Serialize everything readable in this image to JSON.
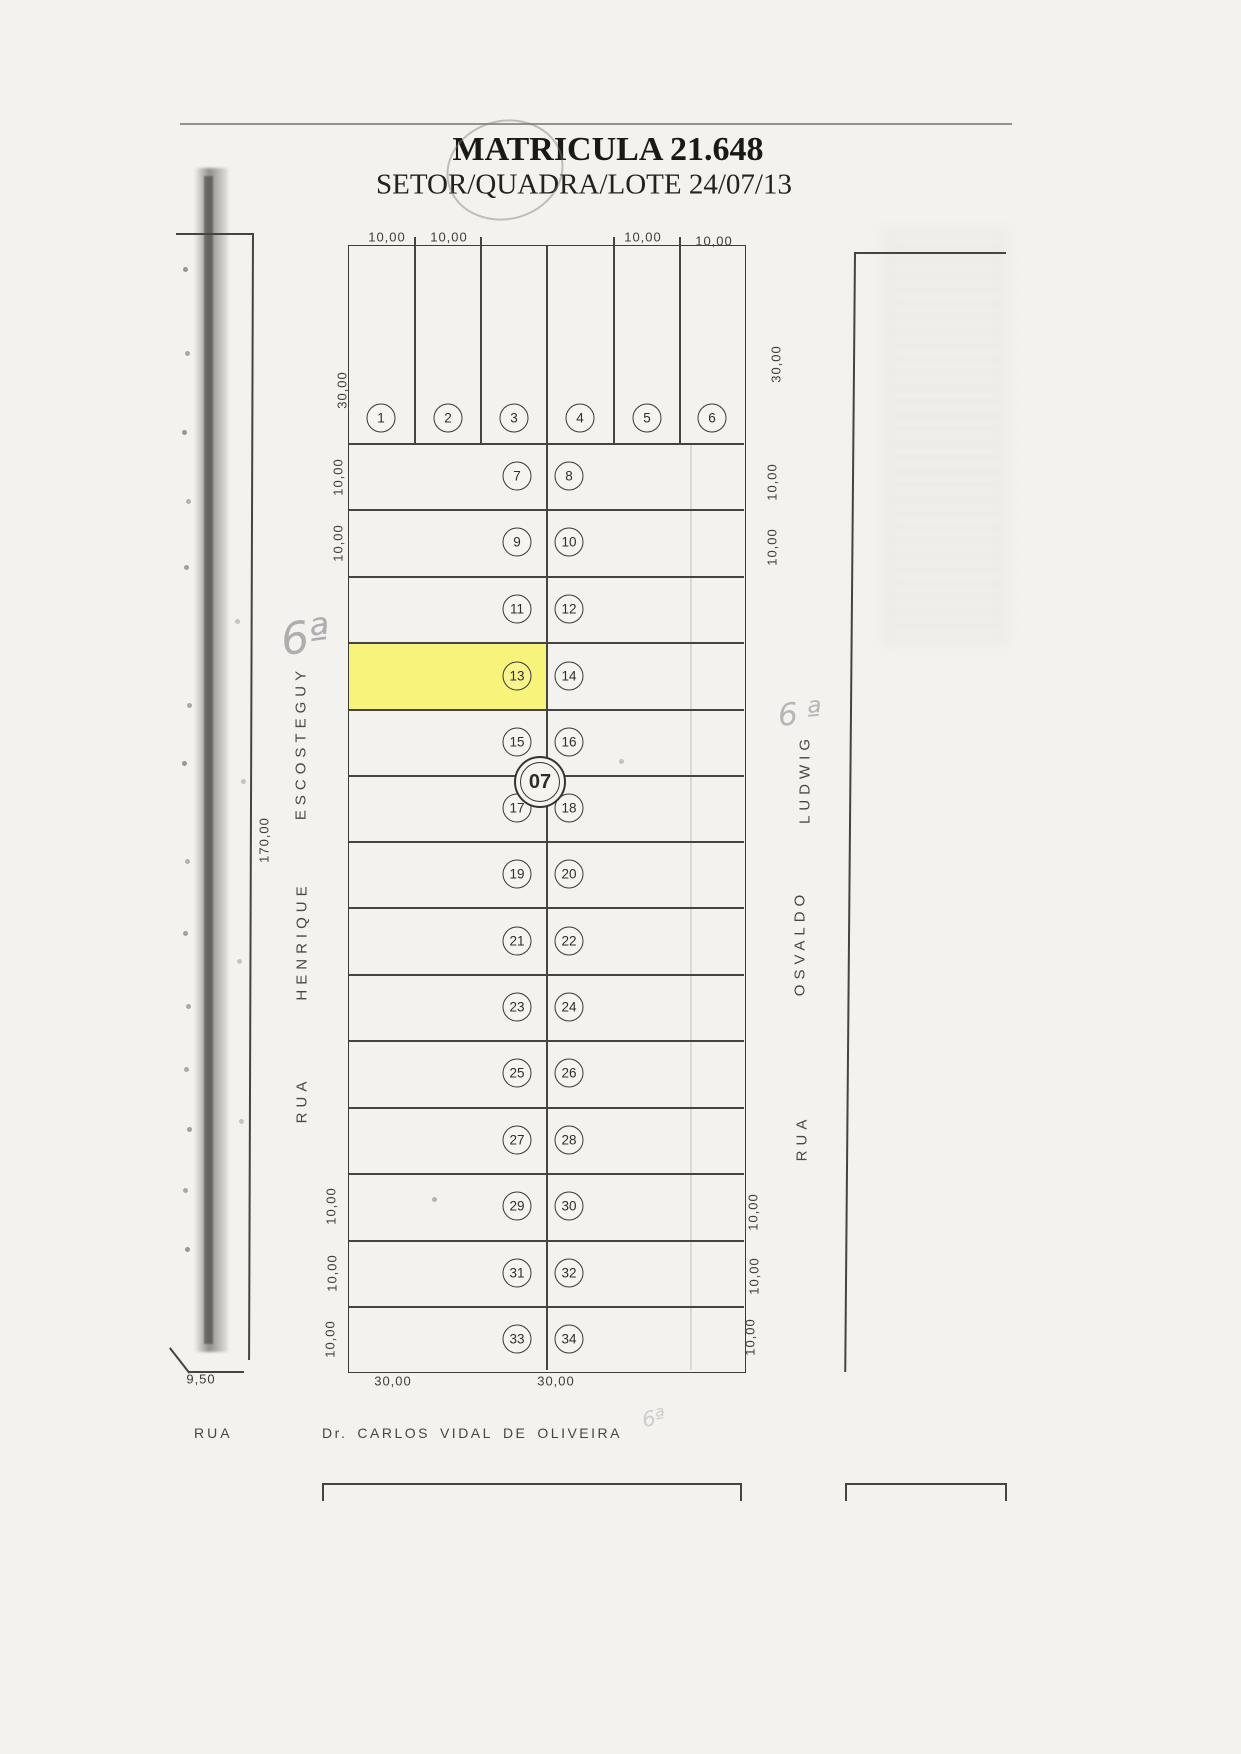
{
  "document": {
    "title": "MATRICULA 21.648",
    "subtitle": "SETOR/QUADRA/LOTE 24/07/13"
  },
  "block": {
    "number": "07",
    "highlighted_lot": "13",
    "highlight_color": "#f8f566"
  },
  "top_lots": [
    "1",
    "2",
    "3",
    "4",
    "5",
    "6"
  ],
  "rows": [
    {
      "l": "7",
      "r": "8"
    },
    {
      "l": "9",
      "r": "10"
    },
    {
      "l": "11",
      "r": "12"
    },
    {
      "l": "13",
      "r": "14"
    },
    {
      "l": "15",
      "r": "16"
    },
    {
      "l": "17",
      "r": "18"
    },
    {
      "l": "19",
      "r": "20"
    },
    {
      "l": "21",
      "r": "22"
    },
    {
      "l": "23",
      "r": "24"
    },
    {
      "l": "25",
      "r": "26"
    },
    {
      "l": "27",
      "r": "28"
    },
    {
      "l": "29",
      "r": "30"
    },
    {
      "l": "31",
      "r": "32"
    },
    {
      "l": "33",
      "r": "34"
    }
  ],
  "dimensions": {
    "top": [
      "10,00",
      "10,00",
      "10,00",
      "10,00"
    ],
    "left": {
      "depth": "30,00",
      "rows": [
        "10,00",
        "10,00"
      ],
      "total": "170,00",
      "bottom_rows": [
        "10,00",
        "10,00",
        "10,00"
      ]
    },
    "right": {
      "depth": "30,00",
      "rows": [
        "10,00",
        "10,00"
      ],
      "bottom_rows": [
        "10,00",
        "10,00",
        "10,00"
      ]
    },
    "bottom": [
      "30,00",
      "30,00"
    ],
    "corner": "9,50"
  },
  "streets": {
    "left": {
      "name": "RUA HENRIQUE ESCOSTEGUY",
      "words": [
        "ESCOSTEGUY",
        "HENRIQUE",
        "RUA"
      ]
    },
    "right": {
      "name": "RUA OSVALDO LUDWIG",
      "words": [
        "LUDWIG",
        "OSVALDO",
        "RUA"
      ]
    },
    "bottom": {
      "rua": "RUA",
      "words": [
        "Dr.",
        "CARLOS",
        "VIDAL",
        "DE",
        "OLIVEIRA"
      ]
    }
  },
  "annotations": {
    "left": "6ª",
    "right": "6ª",
    "bottom": "6ª"
  }
}
